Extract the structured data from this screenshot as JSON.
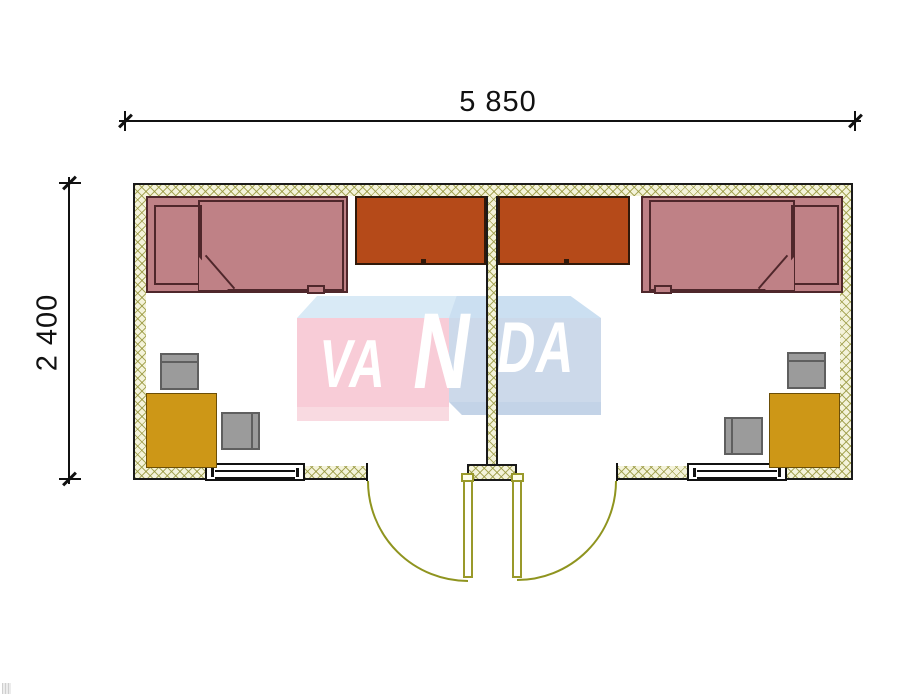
{
  "dimensions": {
    "width": {
      "label": "5 850"
    },
    "height": {
      "label": "2 400"
    }
  },
  "watermark": {
    "brand": "VANDA",
    "segments": {
      "va": "VA",
      "n": "N",
      "da": "DA"
    },
    "colors": {
      "top_band_left": "#d9eaf6",
      "pink_front": "#f8ccd7",
      "pink_bottom": "#f9dae1",
      "top_band_right": "#cbdff1",
      "blue_front": "#ccd9ea",
      "blue_bottom": "#c3d3e7",
      "letters": "#ffffff"
    }
  },
  "plan": {
    "type": "floor-plan",
    "building": "two-room modular cabin",
    "wall_colors": {
      "fill": "#f4f3da",
      "hatch": "#969640",
      "outline": "#1a1a1a"
    },
    "door_color": "#99992a",
    "furniture_colors": {
      "bed": "#bf8186",
      "bed_outline": "#4f272b",
      "wardrobe": "#b54a19",
      "desk": "#cd9717",
      "chair": "#9b9b9b"
    },
    "rooms": [
      {
        "id": "left",
        "furniture": [
          "bed",
          "wardrobe",
          "desk",
          "chair",
          "chair"
        ],
        "openings": [
          "window",
          "door"
        ]
      },
      {
        "id": "right",
        "furniture": [
          "bed",
          "wardrobe",
          "desk",
          "chair",
          "chair"
        ],
        "openings": [
          "window",
          "door"
        ]
      }
    ]
  }
}
